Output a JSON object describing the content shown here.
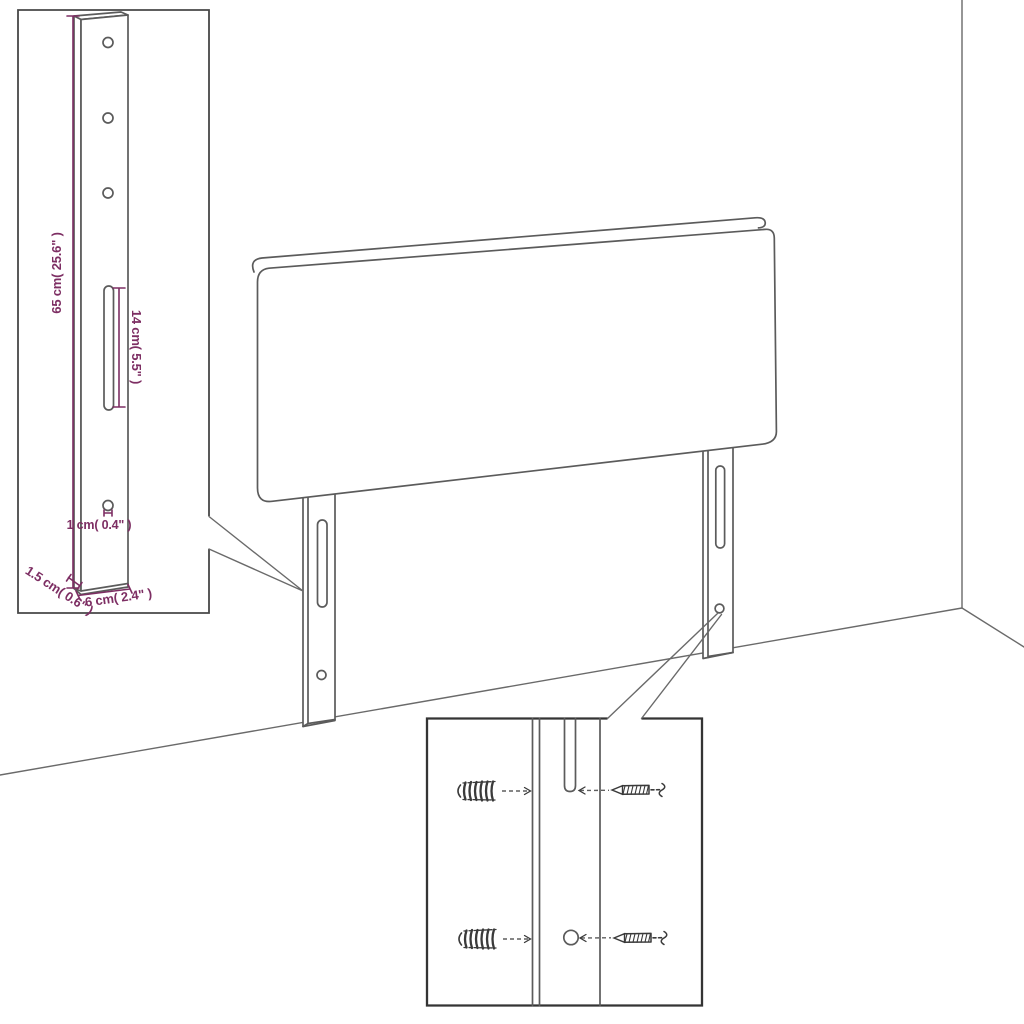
{
  "colors": {
    "outline": "#5b5b5b",
    "dimension": "#7d2e63",
    "inset_border": "#3d3d3d",
    "background": "#ffffff"
  },
  "leg_detail_inset": {
    "height_label": "65 cm( 25.6\" )",
    "slot_label": "14 cm( 5.5\" )",
    "hole_label": "1 cm( 0.4\" )",
    "thickness_label": "1.5 cm( 0.6\" )",
    "width_label": "6 cm( 2.4\" )"
  },
  "hardware_inset": {
    "plug_icon": "wall-plug-icon",
    "screw_icon": "screw-icon"
  }
}
